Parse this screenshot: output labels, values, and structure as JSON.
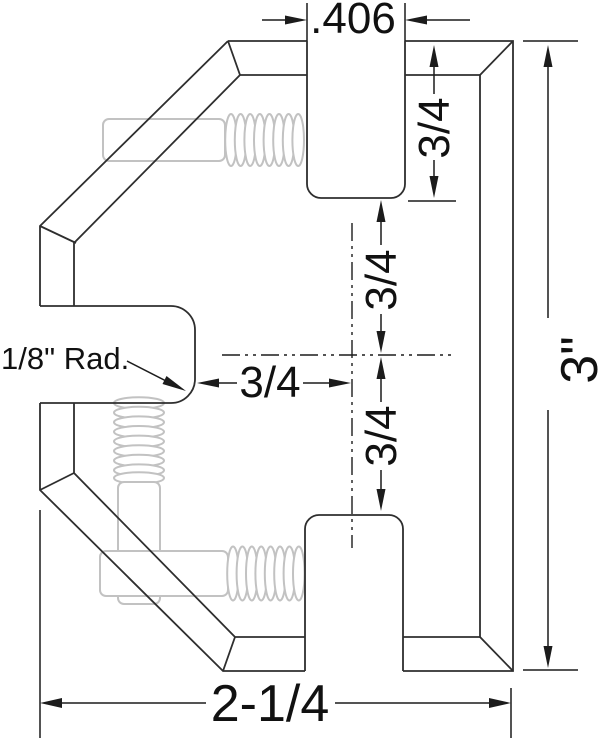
{
  "drawing": {
    "title": "Corner clamp section - dimensioned technical drawing",
    "dim_slot_width": ".406",
    "dim_top_slot_depth": "3/4",
    "dim_center_upper": "3/4",
    "dim_center_lower": "3/4",
    "dim_notch_to_center": "3/4",
    "dim_overall_height": "3\"",
    "dim_overall_width": "2-1/4",
    "note_notch_radius": "1/8\" Rad.",
    "colors": {
      "edge_line": "#2e2e2e",
      "dimension_line": "#1c1c1c",
      "thread_gray": "#c2c2c2",
      "background": "#ffffff"
    }
  }
}
